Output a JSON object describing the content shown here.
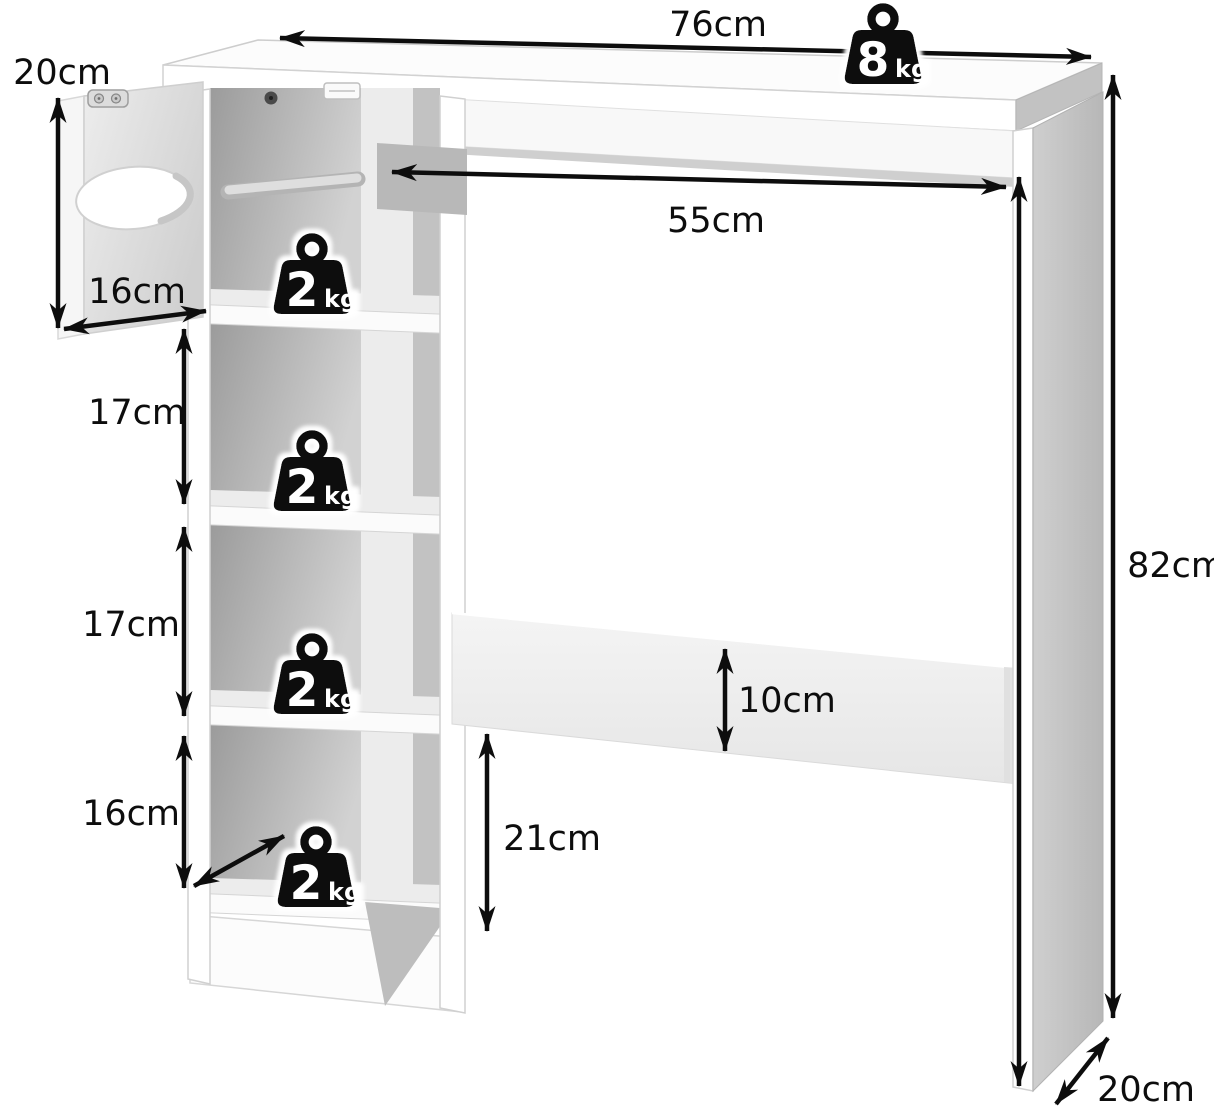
{
  "diagram": {
    "labels": {
      "tabletop_width": "76cm",
      "door_height": "20cm",
      "door_width": "16cm",
      "cubby2_height": "17cm",
      "cubby3_height": "17cm",
      "cubby4_height": "16cm",
      "opening_width": "55cm",
      "unit_height": "82cm",
      "crossbar_width": "10cm",
      "crossbar_clearance": "21cm",
      "leg_depth": "20cm"
    },
    "weights": {
      "tabletop": {
        "value": "8",
        "unit": "kg"
      },
      "cubby1": {
        "value": "2",
        "unit": "kg"
      },
      "cubby2": {
        "value": "2",
        "unit": "kg"
      },
      "cubby3": {
        "value": "2",
        "unit": "kg"
      },
      "cubby4": {
        "value": "2",
        "unit": "kg"
      }
    },
    "colors": {
      "arrow": "#0d0d0d",
      "badge": "#0b0b0b",
      "badge_text": "#ffffff",
      "panel_face": "#ffffff",
      "panel_side": "#c4c4c4",
      "interior_shadow": "#9f9f9f"
    }
  }
}
